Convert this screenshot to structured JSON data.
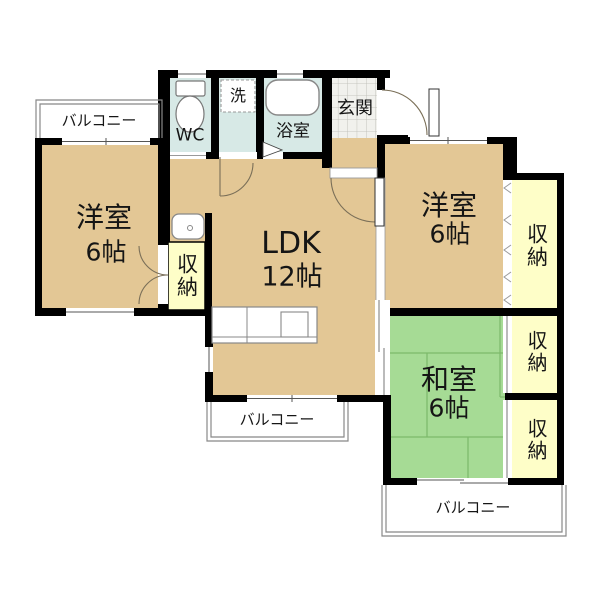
{
  "plan": {
    "type": "apartment-floor-plan",
    "colors": {
      "wall": "#000000",
      "wood_floor": "#E3C795",
      "wet_area": "#D7E9E6",
      "storage": "#FEFEC8",
      "tatami": "#A6DB95",
      "entrance_tile": "#F1F1ED",
      "fence_line": "#888888"
    },
    "rooms": {
      "balcony_top": {
        "label": "バルコニー"
      },
      "west_room": {
        "name": "洋室",
        "size": "6帖"
      },
      "wc": {
        "label": "WC"
      },
      "laundry": {
        "label": "洗"
      },
      "bath": {
        "label": "浴室"
      },
      "entrance": {
        "label": "玄関"
      },
      "east_room": {
        "name": "洋室",
        "size": "6帖"
      },
      "ldk": {
        "name": "LDK",
        "size": "12帖"
      },
      "japanese_room": {
        "name": "和室",
        "size": "6帖"
      },
      "storage_west": {
        "label": "収納"
      },
      "storage_east_top": {
        "label": "収納"
      },
      "storage_east_mid": {
        "label": "収納"
      },
      "storage_east_bottom": {
        "label": "収納"
      },
      "balcony_bottom": {
        "label": "バルコニー"
      },
      "balcony_bottom_right": {
        "label": "バルコニー"
      }
    }
  }
}
